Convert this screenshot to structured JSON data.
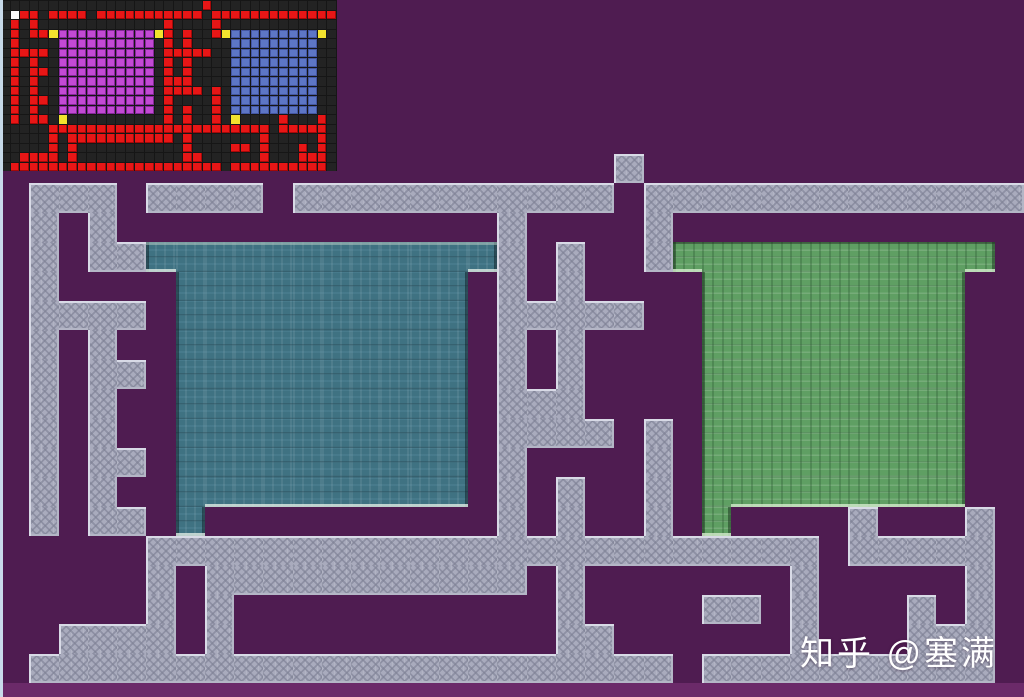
{
  "watermark": {
    "text": "知乎 @塞满"
  },
  "palette": {
    "background_purple": "#4f1c51",
    "background_bottom_strip": "#6b2a69",
    "window_edge_strip": "#c8daea",
    "wall_gray": "#a9abbd",
    "wall_edge_light": "#d8dae6",
    "wall_edge_shade": "#b4b6c6",
    "room_a_floor_teal": "#3f7282",
    "room_a_edge_dark": "rgba(14,34,42,0.55)",
    "room_a_edge_light": "rgba(222,235,228,0.8)",
    "room_a_top_lip": "rgba(175,198,192,0.55)",
    "room_b_floor_green": "#5f9f63",
    "room_b_edge_dark": "rgba(24,50,28,0.5)",
    "room_b_edge_light": "rgba(205,230,198,0.85)",
    "room_b_top_lip": "rgba(28,52,30,0.55)",
    "minimap_bg": "#161616",
    "minimap_empty": "#232323",
    "minimap_wall_red": "#e81616",
    "minimap_wall_bevel": "rgba(110,0,0,0.55)",
    "minimap_room_a_magenta": "#c24ad4",
    "minimap_room_a_grid": "rgba(130,38,150,0.95)",
    "minimap_room_b_blue": "#5d76c6",
    "minimap_room_b_grid": "rgba(66,84,160,0.95)",
    "minimap_marker_yellow": "#f2e22e",
    "minimap_marker_white": "#fafafa"
  },
  "grid": {
    "cols": 35,
    "rows": 18,
    "legend": {
      ".": "empty",
      "#": "wall",
      "a": "room-a-floor",
      "b": "room-b-floor",
      "A": "room-a-door",
      "B": "room-b-door",
      "W": "start-marker-wall"
    },
    "rows_data": [
      ".....................#.............",
      ".W##.####.###########.#############",
      ".#.#.............#....#............",
      ".#.##AaaaaaaaaaaA#.#..#BbbbbbbbbbB.",
      ".#....aaaaaaaaaa.#.#....bbbbbbbbb..",
      ".####.aaaaaaaaaa.#####..bbbbbbbbb..",
      ".#.#..aaaaaaaaaa.#.#....bbbbbbbbb..",
      ".#.##.aaaaaaaaaa.#.#....bbbbbbbbb..",
      ".#.#..aaaaaaaaaa.###....bbbbbbbbb..",
      ".#.#..aaaaaaaaaa.####.#.bbbbbbbbb..",
      ".#.##.aaaaaaaaaa.#....#.bbbbbbbbb..",
      ".#.#..aaaaaaaaaa.#.#..#.bbbbbbbbb..",
      ".#.##.A..........#.#..#.B....#...#.",
      ".....#######################.#####.",
      ".....#.###########.#.......#.....#.",
      ".....#.#...........#....##.#...#.#.",
      "..####.#...........##......#...###.",
      ".######################.##########."
    ]
  },
  "main_view": {
    "cell_height": 29.4,
    "origin_y": 154
  },
  "minimap_view": {
    "width": 337,
    "height": 171,
    "cell_width": 9.6,
    "cell_height": 9.5
  }
}
